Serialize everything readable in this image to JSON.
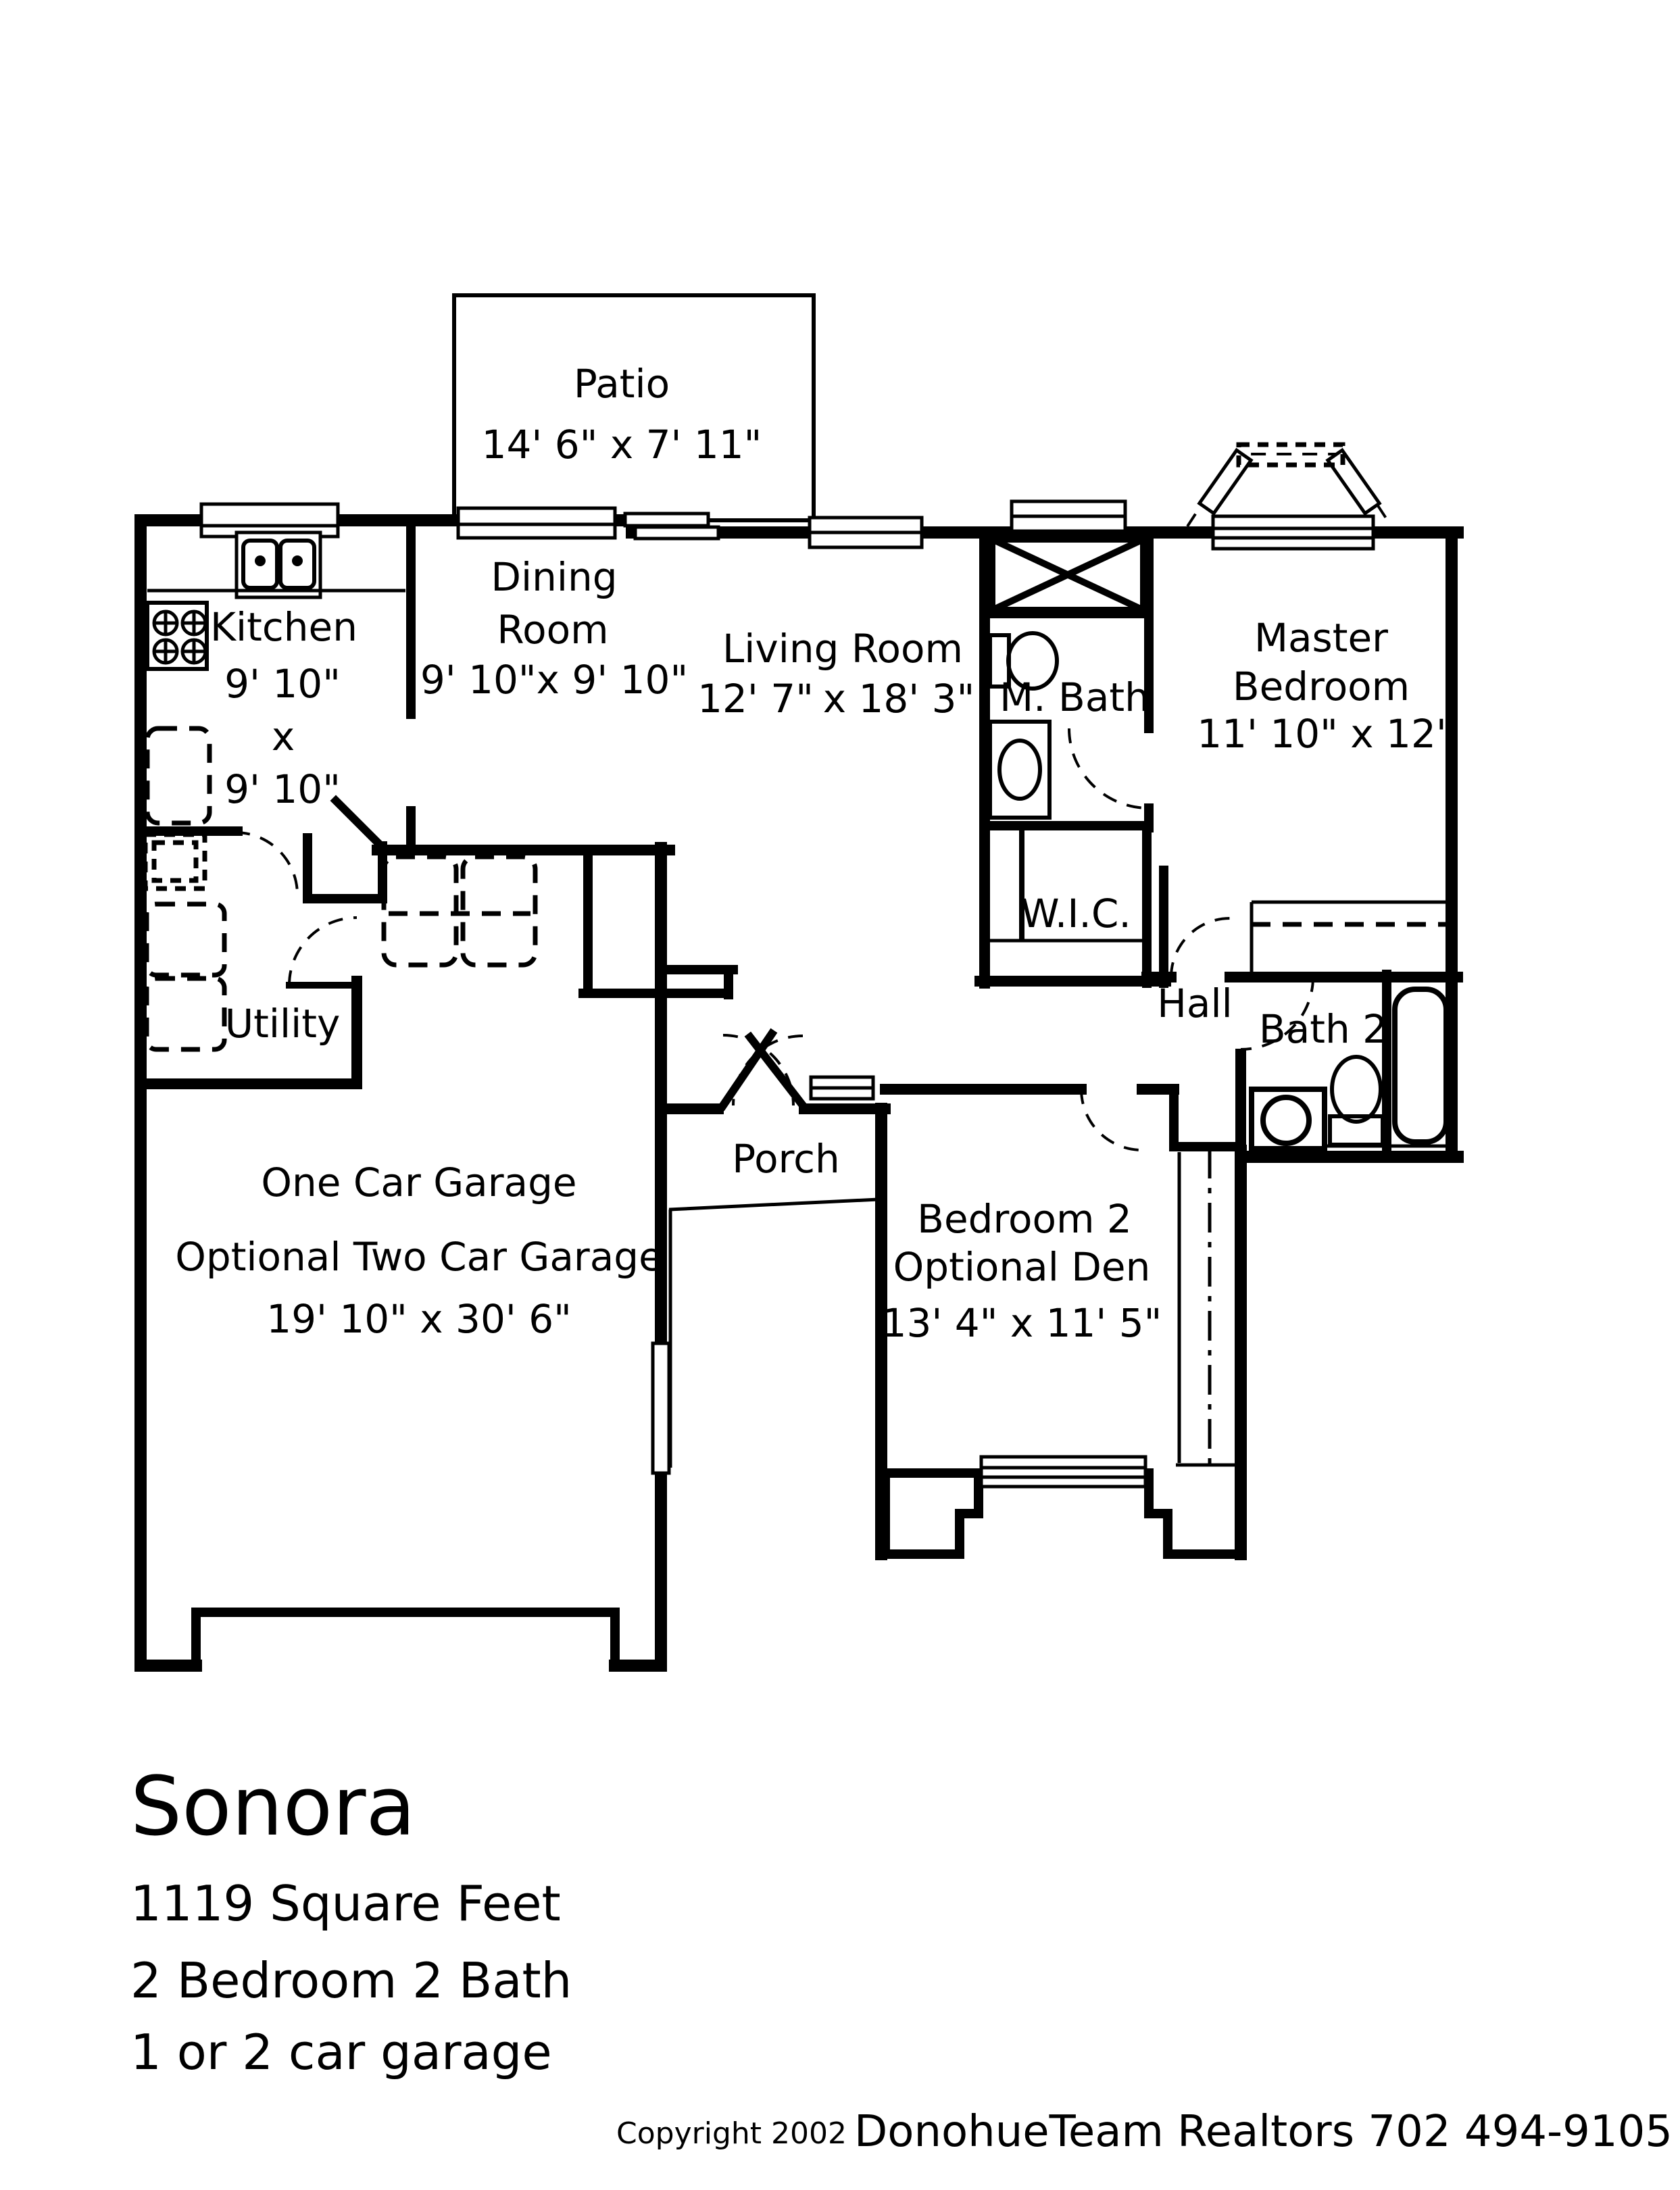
{
  "page": {
    "background": "#ffffff",
    "ink": "#000000"
  },
  "rooms": {
    "patio": {
      "name": "Patio",
      "dims": "14' 6\" x 7' 11\""
    },
    "kitchen": {
      "name": "Kitchen",
      "dim1": "9' 10\"",
      "times": "x",
      "dim2": "9' 10\""
    },
    "dining": {
      "line1": "Dining",
      "line2": "Room",
      "dims": "9' 10\"x 9' 10\""
    },
    "living": {
      "name": "Living Room",
      "dims_a": "12' 7\"",
      "dims_b": "x 18' 3\""
    },
    "master_bath": {
      "name": "M. Bath"
    },
    "master": {
      "line1": "Master",
      "line2": "Bedroom",
      "dims": "11' 10\" x 12'"
    },
    "wic": {
      "name": "W.I.C."
    },
    "hall": {
      "name": "Hall"
    },
    "bath2": {
      "name": "Bath 2"
    },
    "utility": {
      "name": "Utility"
    },
    "garage": {
      "line1": "One Car Garage",
      "line2": "Optional Two Car Garage",
      "dims": "19' 10\" x 30' 6\""
    },
    "porch": {
      "name": "Porch"
    },
    "bedroom2": {
      "line1": "Bedroom 2",
      "line2": "Optional Den",
      "dims": "13' 4\" x 11' 5\""
    }
  },
  "footer": {
    "title": "Sonora",
    "line1": "1119 Square Feet",
    "line2": "2 Bedroom 2 Bath",
    "line3": "1 or 2 car garage"
  },
  "copyright": {
    "prefix": "Copyright 2002",
    "company": "DonohueTeam Realtors 702 494-9105"
  }
}
